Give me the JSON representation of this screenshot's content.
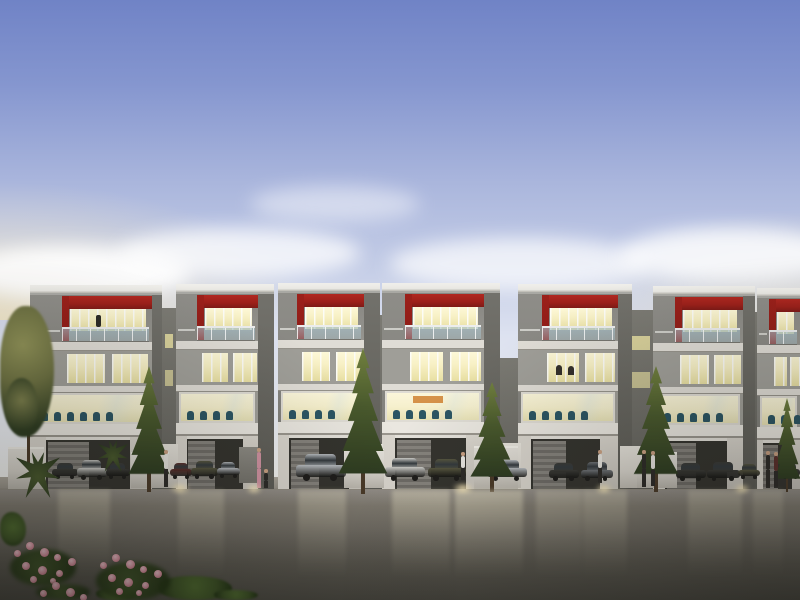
{
  "meta": {
    "description": "Dusk architectural rendering of a row of modern three-storey townhouses with red accent bands, lit interiors, street trees, parked cars, pedestrians and a wet reflective roadway; pink flowers in the lower-left foreground",
    "width": 800,
    "height": 600
  },
  "palette": {
    "sky-top": "#7083c6",
    "sky-mid": "#a9b5dc",
    "sky-low": "#dde2f0",
    "sky-horizon": "#f5f4ef",
    "glow-warm": "#f2e8cc",
    "roof-white": "#e9e8e3",
    "roof-edge": "#b9b7b0",
    "side-face": "#72716b",
    "side-face-dark": "#5c5b55",
    "wall-gray": "#9d9c96",
    "wall-dark": "#868580",
    "wall-col": "#8e8d88",
    "wall-recess": "#7b7a73",
    "accent-red": "#9c201a",
    "accent-red-dark": "#7e1a16",
    "slab-white": "#dfdcd5",
    "fascia-white": "#eae7e0",
    "win-warm": "#f7f0c4",
    "win-warm-deep": "#e8dfa2",
    "mullion": "#fbfaf5",
    "window-dim": "#6b6b5a",
    "rail-glass": "#a9c3cd",
    "interior-warm": "#f6f0cd",
    "chair-teal": "#2b5563",
    "accent-orange": "#cf8030",
    "garage-dark": "#34332e",
    "garage-door": "#7c7973",
    "wall-white": "#d9d5cd",
    "apron": "#a8a297",
    "road-top": "#95908a",
    "road-mid": "#6b675f",
    "road-bottom": "#4b4942",
    "tree-dark": "#2e3c21",
    "tree-mid": "#4a5a2d",
    "tree-light": "#71803f",
    "tree-olive": "#8f9157",
    "trunk": "#4a3a28",
    "planter-white": "#d6d2ca",
    "car-white": "#cbcbc7",
    "car-silver": "#b7bbbf",
    "car-graphite": "#6e7276",
    "car-dark": "#3a3a36",
    "car-olive": "#56553f",
    "car-maroon": "#5c302c",
    "wheel": "#1e1d1b",
    "car-glass": "#33393d",
    "shirt-white": "#e7e5df",
    "pants-dark": "#2d2b28",
    "dress-pink": "#d193a2",
    "skin": "#caa183",
    "flower-pink": "#dc96a4",
    "flower-deep": "#bd6b7e",
    "leaf-green": "#3c5224"
  },
  "clouds": [
    {
      "x": -40,
      "y": 246,
      "w": 230,
      "h": 54,
      "o": 0.9
    },
    {
      "x": 120,
      "y": 228,
      "w": 240,
      "h": 50,
      "o": 0.75
    },
    {
      "x": 390,
      "y": 238,
      "w": 260,
      "h": 52,
      "o": 0.7
    },
    {
      "x": 620,
      "y": 228,
      "w": 220,
      "h": 54,
      "o": 0.8
    },
    {
      "x": 250,
      "y": 186,
      "w": 170,
      "h": 36,
      "o": 0.45
    }
  ],
  "units": [
    {
      "x": 30,
      "w": 122,
      "side": 10,
      "roof_y": 285,
      "col_w": 32,
      "f3_figure": true
    },
    {
      "x": 176,
      "w": 82,
      "side": 16,
      "roof_y": 284,
      "col_w": 21
    },
    {
      "x": 278,
      "w": 86,
      "side": 16,
      "roof_y": 283,
      "col_w": 19
    },
    {
      "x": 382,
      "w": 102,
      "side": 16,
      "roof_y": 283,
      "col_w": 23,
      "interior_accent": true
    },
    {
      "x": 518,
      "w": 100,
      "side": 14,
      "roof_y": 284,
      "col_w": 24,
      "f2_occupants": true
    },
    {
      "x": 653,
      "w": 90,
      "side": 12,
      "roof_y": 286,
      "col_w": 22
    },
    {
      "x": 757,
      "w": 43,
      "side": 0,
      "roof_y": 288,
      "col_w": 12
    }
  ],
  "gap_walls": [
    {
      "x": 162,
      "w": 14,
      "y": 308,
      "lit": true
    },
    {
      "x": 364,
      "w": 18,
      "y": 315
    },
    {
      "x": 500,
      "w": 18,
      "y": 358
    },
    {
      "x": 618,
      "w": 35,
      "y": 310,
      "lit": true
    },
    {
      "x": 743,
      "w": 14,
      "y": 312
    }
  ],
  "low_walls": [
    {
      "x": 152,
      "w": 26,
      "y": 444,
      "h": 44
    },
    {
      "x": 239,
      "w": 19,
      "y": 447,
      "h": 36,
      "gray": true
    },
    {
      "x": 365,
      "w": 18,
      "y": 444,
      "h": 44
    },
    {
      "x": 497,
      "w": 24,
      "y": 443,
      "h": 45
    },
    {
      "x": 620,
      "w": 32,
      "y": 446,
      "h": 42
    }
  ],
  "planters": [
    {
      "x": 8,
      "y": 447,
      "w": 36,
      "h": 42
    },
    {
      "x": 131,
      "y": 452,
      "w": 38,
      "h": 36
    },
    {
      "x": 344,
      "y": 449,
      "w": 40,
      "h": 39
    },
    {
      "x": 474,
      "y": 446,
      "w": 44,
      "h": 43
    },
    {
      "x": 637,
      "y": 452,
      "w": 40,
      "h": 36
    }
  ],
  "trees": [
    {
      "t": "deciduous",
      "x": 0,
      "y": 306,
      "w": 54,
      "h": 160
    },
    {
      "t": "conifer",
      "x": 126,
      "y": 366,
      "w": 46,
      "h": 126
    },
    {
      "t": "conifer",
      "x": 336,
      "y": 348,
      "w": 54,
      "h": 146
    },
    {
      "t": "conifer",
      "x": 468,
      "y": 382,
      "w": 48,
      "h": 110
    },
    {
      "t": "conifer",
      "x": 631,
      "y": 366,
      "w": 50,
      "h": 126
    },
    {
      "t": "conifer",
      "x": 772,
      "y": 398,
      "w": 30,
      "h": 94
    },
    {
      "t": "palm",
      "x": 16,
      "y": 452,
      "w": 44,
      "h": 46
    },
    {
      "t": "palm",
      "x": 98,
      "y": 440,
      "w": 30,
      "h": 32
    }
  ],
  "cars": [
    {
      "x": 52,
      "y": 463,
      "w": 26,
      "h": 15,
      "c": "car-dark"
    },
    {
      "x": 77,
      "y": 460,
      "w": 30,
      "h": 19,
      "c": "car-white"
    },
    {
      "x": 106,
      "y": 463,
      "w": 24,
      "h": 15,
      "c": "car-dark"
    },
    {
      "x": 170,
      "y": 463,
      "w": 22,
      "h": 15,
      "c": "car-maroon"
    },
    {
      "x": 191,
      "y": 461,
      "w": 27,
      "h": 17,
      "c": "car-olive"
    },
    {
      "x": 217,
      "y": 462,
      "w": 23,
      "h": 15,
      "c": "car-silver"
    },
    {
      "x": 296,
      "y": 454,
      "w": 50,
      "h": 26,
      "c": "car-silver"
    },
    {
      "x": 385,
      "y": 458,
      "w": 40,
      "h": 22,
      "c": "car-white"
    },
    {
      "x": 428,
      "y": 459,
      "w": 38,
      "h": 21,
      "c": "car-olive"
    },
    {
      "x": 487,
      "y": 460,
      "w": 40,
      "h": 20,
      "c": "car-silver"
    },
    {
      "x": 549,
      "y": 463,
      "w": 30,
      "h": 17,
      "c": "car-dark"
    },
    {
      "x": 581,
      "y": 462,
      "w": 32,
      "h": 18,
      "c": "car-graphite"
    },
    {
      "x": 676,
      "y": 463,
      "w": 30,
      "h": 17,
      "c": "car-dark"
    },
    {
      "x": 707,
      "y": 462,
      "w": 33,
      "h": 18,
      "c": "car-dark"
    },
    {
      "x": 738,
      "y": 464,
      "w": 22,
      "h": 14,
      "c": "car-olive"
    },
    {
      "x": 780,
      "y": 463,
      "w": 20,
      "h": 15,
      "c": "car-dark"
    }
  ],
  "people": [
    {
      "x": 163,
      "y": 450,
      "h": 37,
      "top": "shirt-white",
      "bot": "pants-dark"
    },
    {
      "x": 256,
      "y": 448,
      "h": 40,
      "top": "dress-pink",
      "bot": "dress-pink"
    },
    {
      "x": 263,
      "y": 469,
      "h": 19,
      "top": "pants-dark",
      "bot": "pants-dark"
    },
    {
      "x": 460,
      "y": 452,
      "h": 28,
      "top": "shirt-white",
      "bot": "pants-dark"
    },
    {
      "x": 597,
      "y": 450,
      "h": 33,
      "top": "shirt-white",
      "bot": "pants-dark"
    },
    {
      "x": 641,
      "y": 450,
      "h": 37,
      "top": "pants-dark",
      "bot": "pants-dark"
    },
    {
      "x": 650,
      "y": 451,
      "h": 35,
      "top": "shirt-white",
      "bot": "pants-dark"
    },
    {
      "x": 765,
      "y": 451,
      "h": 37,
      "top": "pants-dark",
      "bot": "pants-dark"
    },
    {
      "x": 773,
      "y": 452,
      "h": 36,
      "top": "car-maroon",
      "bot": "pants-dark"
    }
  ],
  "reflections": [
    {
      "x": 58,
      "w": 52,
      "o": 0.3
    },
    {
      "x": 178,
      "w": 46,
      "o": 0.28
    },
    {
      "x": 298,
      "w": 48,
      "o": 0.32
    },
    {
      "x": 392,
      "w": 58,
      "o": 0.4
    },
    {
      "x": 455,
      "w": 68,
      "o": 0.45
    },
    {
      "x": 536,
      "w": 46,
      "o": 0.26
    },
    {
      "x": 583,
      "w": 44,
      "o": 0.3
    },
    {
      "x": 688,
      "w": 54,
      "o": 0.28
    },
    {
      "x": 753,
      "w": 30,
      "o": 0.22
    }
  ],
  "glow_spots": [
    {
      "x": 166,
      "y": 484,
      "w": 28,
      "h": 9
    },
    {
      "x": 243,
      "y": 485,
      "w": 22,
      "h": 8
    },
    {
      "x": 448,
      "y": 484,
      "w": 30,
      "h": 9
    },
    {
      "x": 592,
      "y": 485,
      "w": 24,
      "h": 8
    },
    {
      "x": 730,
      "y": 485,
      "w": 24,
      "h": 8
    }
  ],
  "flowers": {
    "clusters": [
      {
        "x": 10,
        "y": 540,
        "w": 66,
        "h": 46
      },
      {
        "x": 96,
        "y": 552,
        "w": 74,
        "h": 48
      },
      {
        "x": 36,
        "y": 580,
        "w": 54,
        "h": 20
      }
    ],
    "dots": [
      [
        4,
        10,
        7
      ],
      [
        16,
        2,
        8
      ],
      [
        30,
        8,
        9
      ],
      [
        44,
        14,
        7
      ],
      [
        12,
        22,
        8
      ],
      [
        28,
        26,
        9
      ],
      [
        46,
        30,
        7
      ],
      [
        58,
        18,
        8
      ],
      [
        20,
        36,
        7
      ],
      [
        40,
        38,
        6
      ]
    ]
  },
  "foliage": [
    {
      "x": 158,
      "y": 576,
      "w": 74,
      "h": 24
    },
    {
      "x": 0,
      "y": 512,
      "w": 26,
      "h": 34
    },
    {
      "x": 214,
      "y": 590,
      "w": 44,
      "h": 10
    },
    {
      "x": 96,
      "y": 588,
      "w": 40,
      "h": 12
    }
  ]
}
